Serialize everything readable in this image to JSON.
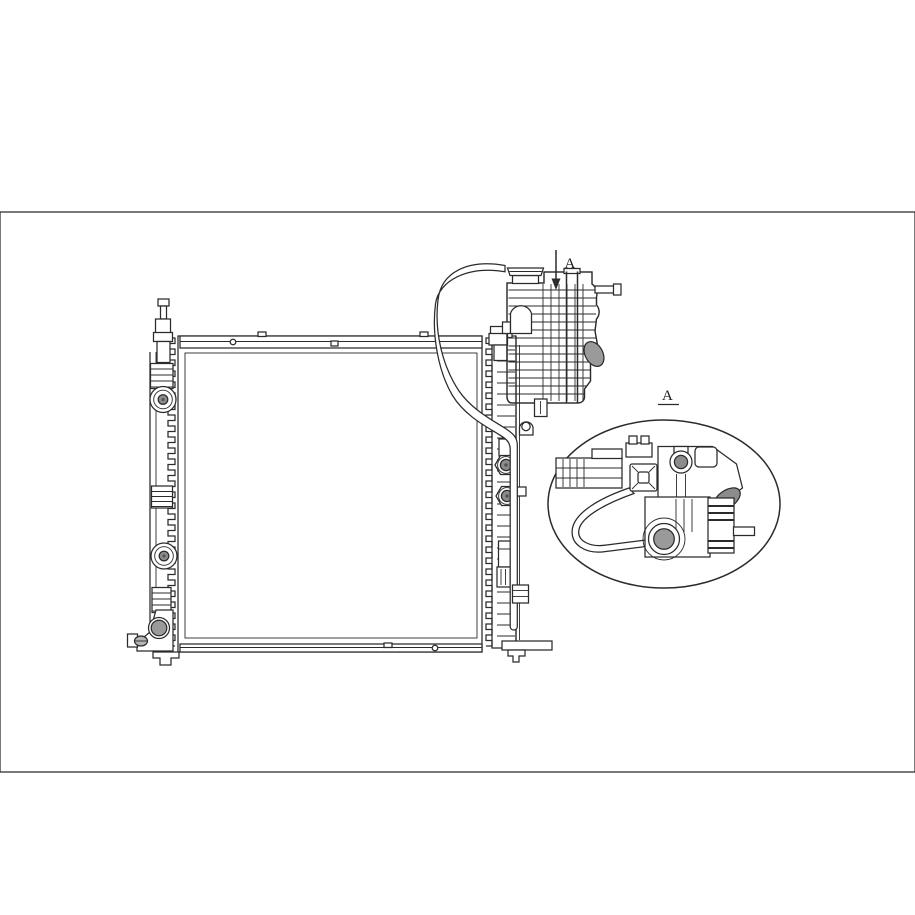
{
  "artwork": {
    "watermark": {
      "text": "MIR-AUTO",
      "color": "#c6c6c6"
    },
    "labels": {
      "section_arrow": "A",
      "detail_view": "A"
    },
    "palette": {
      "line": "#2b2b2b",
      "background": "#ffffff",
      "fill_light_gray": "#9a9a9a",
      "fill_mid_gray": "#8c8c8c"
    }
  }
}
